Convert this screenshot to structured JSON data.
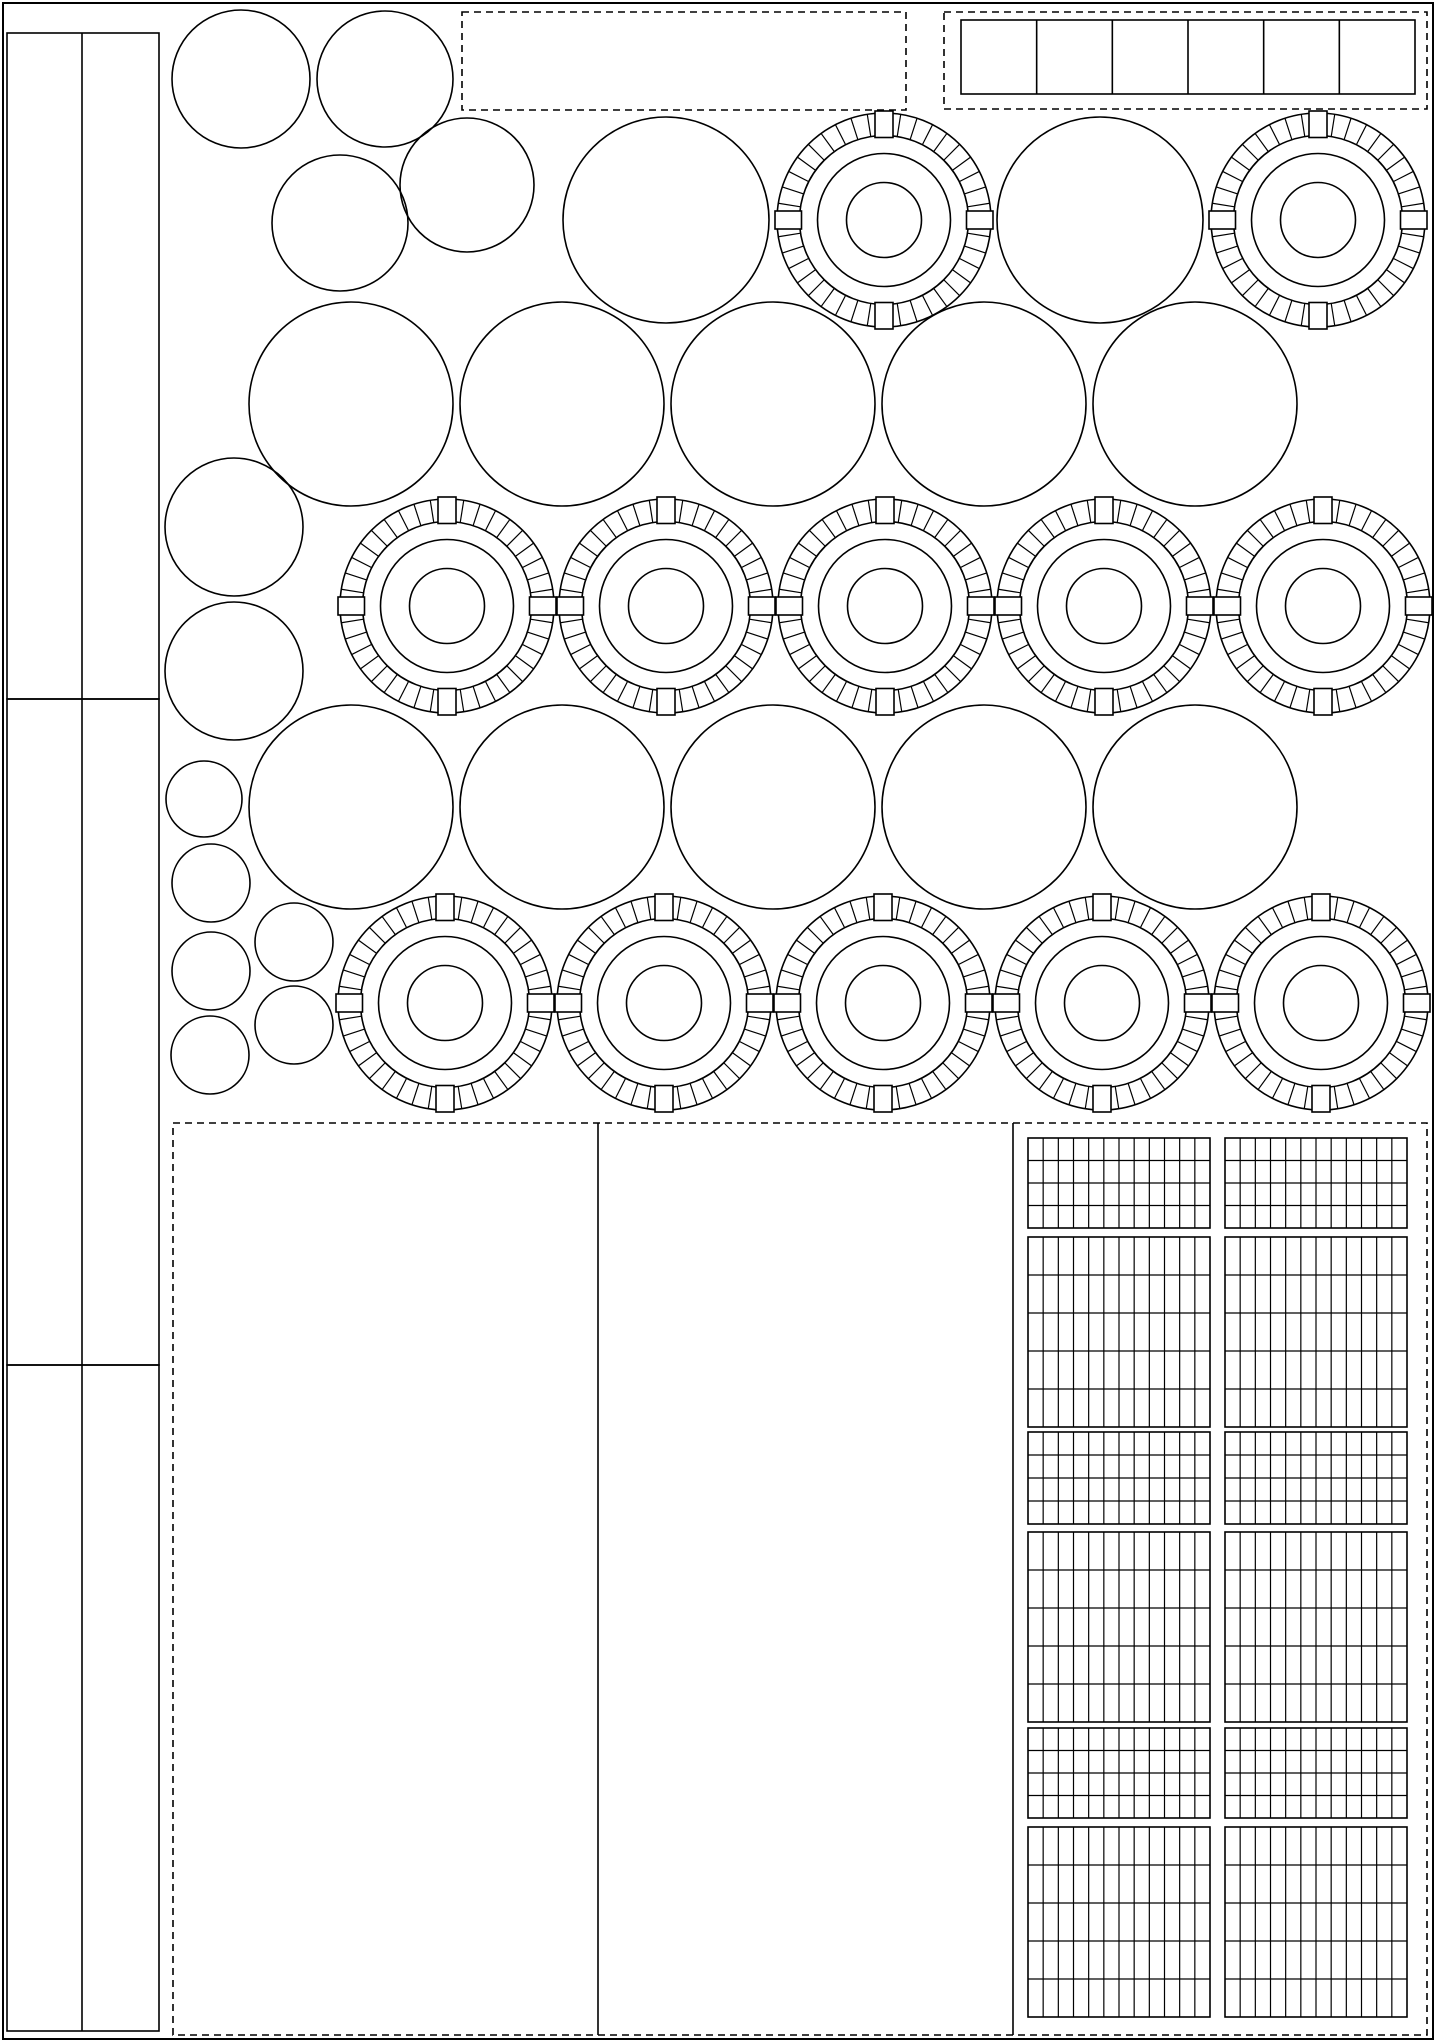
{
  "sheet": {
    "width": 1437,
    "height": 2043,
    "background": "#ffffff",
    "line_color": "#000000"
  },
  "style": {
    "lw_main": 1.6,
    "lw_fine": 1.2,
    "dash_pattern": "7 5"
  },
  "page_border": {
    "x": 3,
    "y": 3,
    "w": 1430,
    "h": 2036
  },
  "strips": {
    "x": 7,
    "w": 152,
    "divider_x": 82,
    "segments": [
      {
        "y0": 33,
        "y1": 699
      },
      {
        "y0": 699,
        "y1": 1365
      },
      {
        "y0": 1365,
        "y1": 2031
      }
    ]
  },
  "dashed_boxes": [
    {
      "x": 462,
      "y": 12,
      "w": 444,
      "h": 98
    },
    {
      "x": 944,
      "y": 12,
      "w": 483,
      "h": 97
    }
  ],
  "squares_row": {
    "x": 961,
    "y": 20,
    "w": 454,
    "h": 74,
    "cells": 6
  },
  "discs": {
    "medium": [
      [
        241,
        79,
        69
      ],
      [
        385,
        79,
        68
      ],
      [
        340,
        223,
        68
      ],
      [
        467,
        185,
        67
      ],
      [
        234,
        527,
        69
      ],
      [
        234,
        671,
        69
      ]
    ],
    "small": [
      [
        204,
        799,
        38
      ],
      [
        211,
        883,
        39
      ],
      [
        211,
        971,
        39
      ],
      [
        210,
        1055,
        39
      ],
      [
        294,
        942,
        39
      ],
      [
        294,
        1025,
        39
      ]
    ],
    "large": [
      [
        666,
        220,
        103
      ],
      [
        1100,
        220,
        103
      ],
      [
        351,
        404,
        102
      ],
      [
        562,
        404,
        102
      ],
      [
        773,
        404,
        102
      ],
      [
        984,
        404,
        102
      ],
      [
        1195,
        404,
        102
      ],
      [
        351,
        807,
        102
      ],
      [
        562,
        807,
        102
      ],
      [
        773,
        807,
        102
      ],
      [
        984,
        807,
        102
      ],
      [
        1195,
        807,
        102
      ]
    ]
  },
  "wheels": {
    "outer_r": 107,
    "tread_r": 84.5,
    "rim_r": 66.5,
    "hub_r": 37.5,
    "tick_step_deg": 9,
    "block_w": 18,
    "block_overhang": 2,
    "centers": [
      [
        884,
        220
      ],
      [
        1318,
        220
      ],
      [
        447,
        606
      ],
      [
        666,
        606
      ],
      [
        885,
        606
      ],
      [
        1104,
        606
      ],
      [
        1323,
        606
      ],
      [
        445,
        1003
      ],
      [
        664,
        1003
      ],
      [
        883,
        1003
      ],
      [
        1102,
        1003
      ],
      [
        1321,
        1003
      ]
    ]
  },
  "bottom_panel": {
    "x": 173,
    "y": 1123,
    "w": 1254,
    "h": 912,
    "dividers_x": [
      598,
      1013
    ]
  },
  "grids": {
    "cols": 12,
    "col_x": [
      1028,
      1225
    ],
    "block_w": 182,
    "rows": [
      {
        "y": 1138,
        "h": 90,
        "rows": 4
      },
      {
        "y": 1237,
        "h": 190,
        "rows": 5
      },
      {
        "y": 1432,
        "h": 92,
        "rows": 4
      },
      {
        "y": 1532,
        "h": 190,
        "rows": 5
      },
      {
        "y": 1728,
        "h": 90,
        "rows": 4
      },
      {
        "y": 1827,
        "h": 190,
        "rows": 5
      }
    ]
  }
}
